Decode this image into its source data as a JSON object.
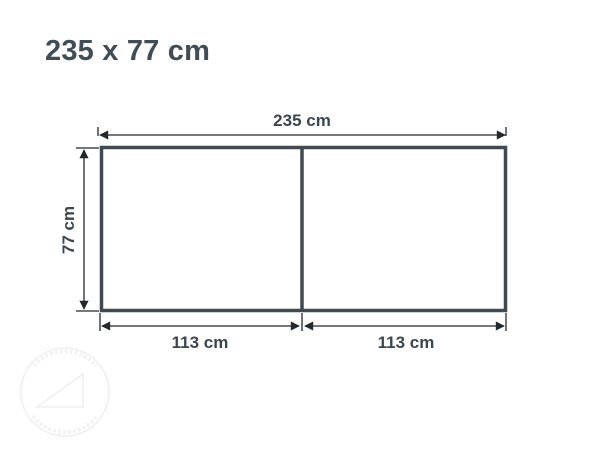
{
  "title": "235 x 77 cm",
  "unit": "cm",
  "dimensions": {
    "total_width": 235,
    "total_height": 77,
    "sections": [
      113,
      113
    ]
  },
  "labels": {
    "total_width": "235 cm",
    "height": "77 cm",
    "section_left": "113 cm",
    "section_right": "113 cm"
  },
  "colors": {
    "outline": "#3f4a53",
    "dimension_line": "#23282c",
    "label_text": "#3b4750",
    "title_text": "#3e4d57",
    "watermark": "#f0f0f0",
    "background": "#ffffff"
  },
  "watermark": {
    "description": "faint circular stamp with triangle logo and curved illegible text"
  }
}
